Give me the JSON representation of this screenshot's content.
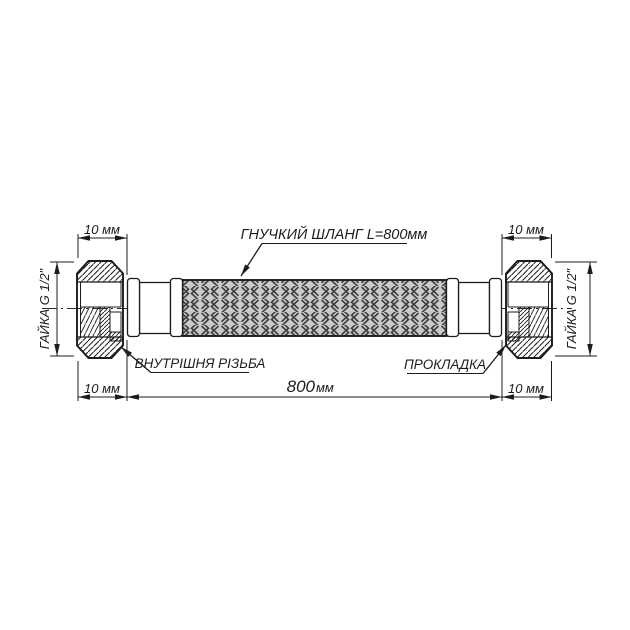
{
  "drawing": {
    "title_label": "ГНУЧКИЙ ШЛАНГ L=800мм",
    "labels": {
      "internal_thread": "ВНУТРІШНЯ РІЗЬБА",
      "gasket": "ПРОКЛАДКА",
      "nut_left": "ГАЙКА G 1/2\"",
      "nut_right": "ГАЙКА G 1/2\""
    },
    "dimensions": {
      "nut_width_top_left": "10 мм",
      "nut_width_top_right": "10 мм",
      "nut_width_bottom_left": "10 мм",
      "nut_width_bottom_right": "10 мм",
      "total_length_value": "800",
      "total_length_unit": "мм"
    },
    "colors": {
      "line": "#1c1c1c",
      "braid_fill": "#cacaca",
      "braid_stroke": "#3f3f3f",
      "background": "#ffffff"
    }
  }
}
